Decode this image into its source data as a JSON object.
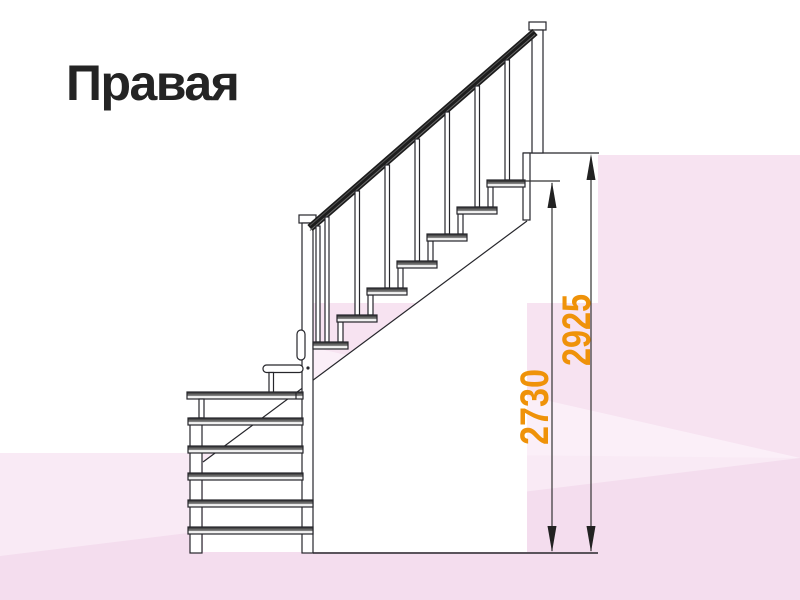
{
  "page": {
    "title": "Правая"
  },
  "diagram": {
    "type": "staircase-side-elevation",
    "dimensions": [
      {
        "id": "dim-2730",
        "label": "2730",
        "measures": "height from floor to top step"
      },
      {
        "id": "dim-2925",
        "label": "2925",
        "measures": "height from floor to upper floor level"
      }
    ],
    "colors": {
      "accent": "#EF9209",
      "line": "#26262B",
      "rail": "#1C1C1C",
      "pink_base": "#F9EAF5",
      "pink_facet_dark": "#F7E3F1",
      "pink_facet_light": "#FBEFF8",
      "pink_facet_bottom": "#F4DDEE",
      "white": "#FFFFFF"
    }
  }
}
